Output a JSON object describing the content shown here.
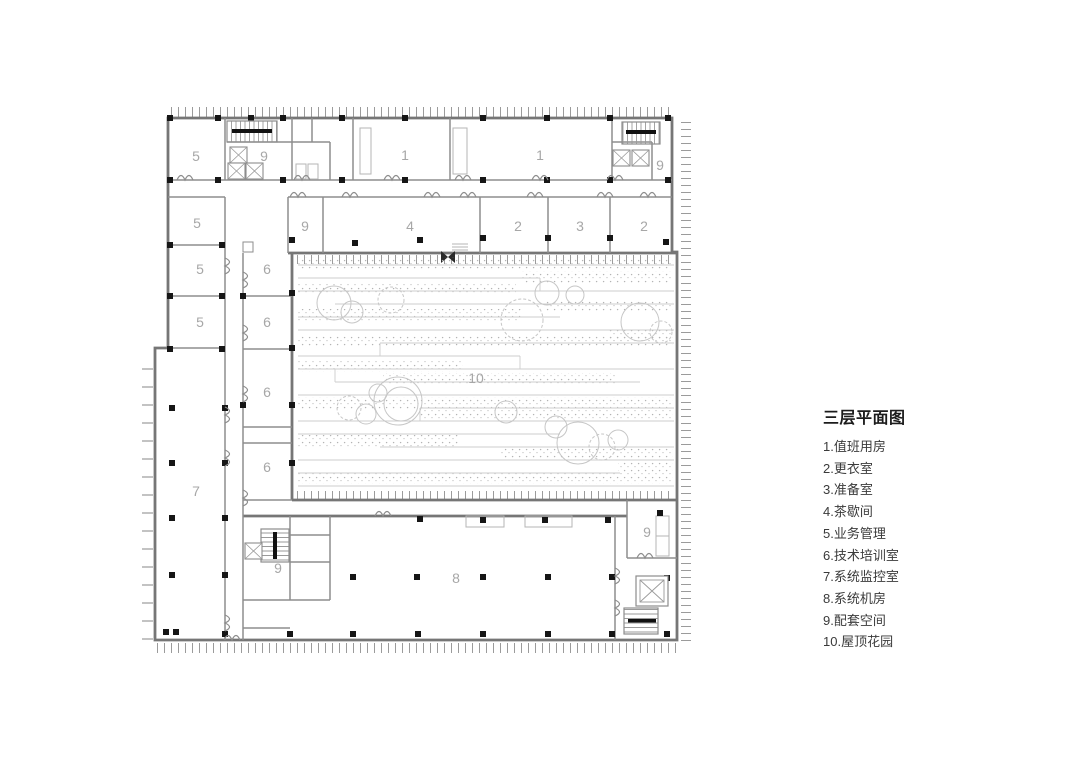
{
  "page": {
    "background": "#ffffff",
    "kind": "architectural floor plan"
  },
  "legend": {
    "title": "三层平面图",
    "items": [
      "1.值班用房",
      "2.更衣室",
      "3.准备室",
      "4.茶歇间",
      "5.业务管理",
      "6.技术培训室",
      "7.系统监控室",
      "8.系统机房",
      "9.配套空间",
      "10.屋顶花园"
    ]
  },
  "plan": {
    "room_labels": [
      {
        "label": "5"
      },
      {
        "label": "9"
      },
      {
        "label": "1"
      },
      {
        "label": "1"
      },
      {
        "label": "9"
      },
      {
        "label": "5"
      },
      {
        "label": "9"
      },
      {
        "label": "4"
      },
      {
        "label": "2"
      },
      {
        "label": "3"
      },
      {
        "label": "2"
      },
      {
        "label": "5"
      },
      {
        "label": "5"
      },
      {
        "label": "6"
      },
      {
        "label": "6"
      },
      {
        "label": "6"
      },
      {
        "label": "6"
      },
      {
        "label": "7"
      },
      {
        "label": "10"
      },
      {
        "label": "9"
      },
      {
        "label": "8"
      },
      {
        "label": "9"
      }
    ],
    "colors": {
      "exterior_wall": "#767676",
      "interior_wall": "#8d8d8d",
      "column": "#161616",
      "room_label": "#a7a7a7",
      "tick": "#9b9b9b",
      "garden_line": "#cdcdcd",
      "legend_text": "#3a3a3a"
    }
  }
}
